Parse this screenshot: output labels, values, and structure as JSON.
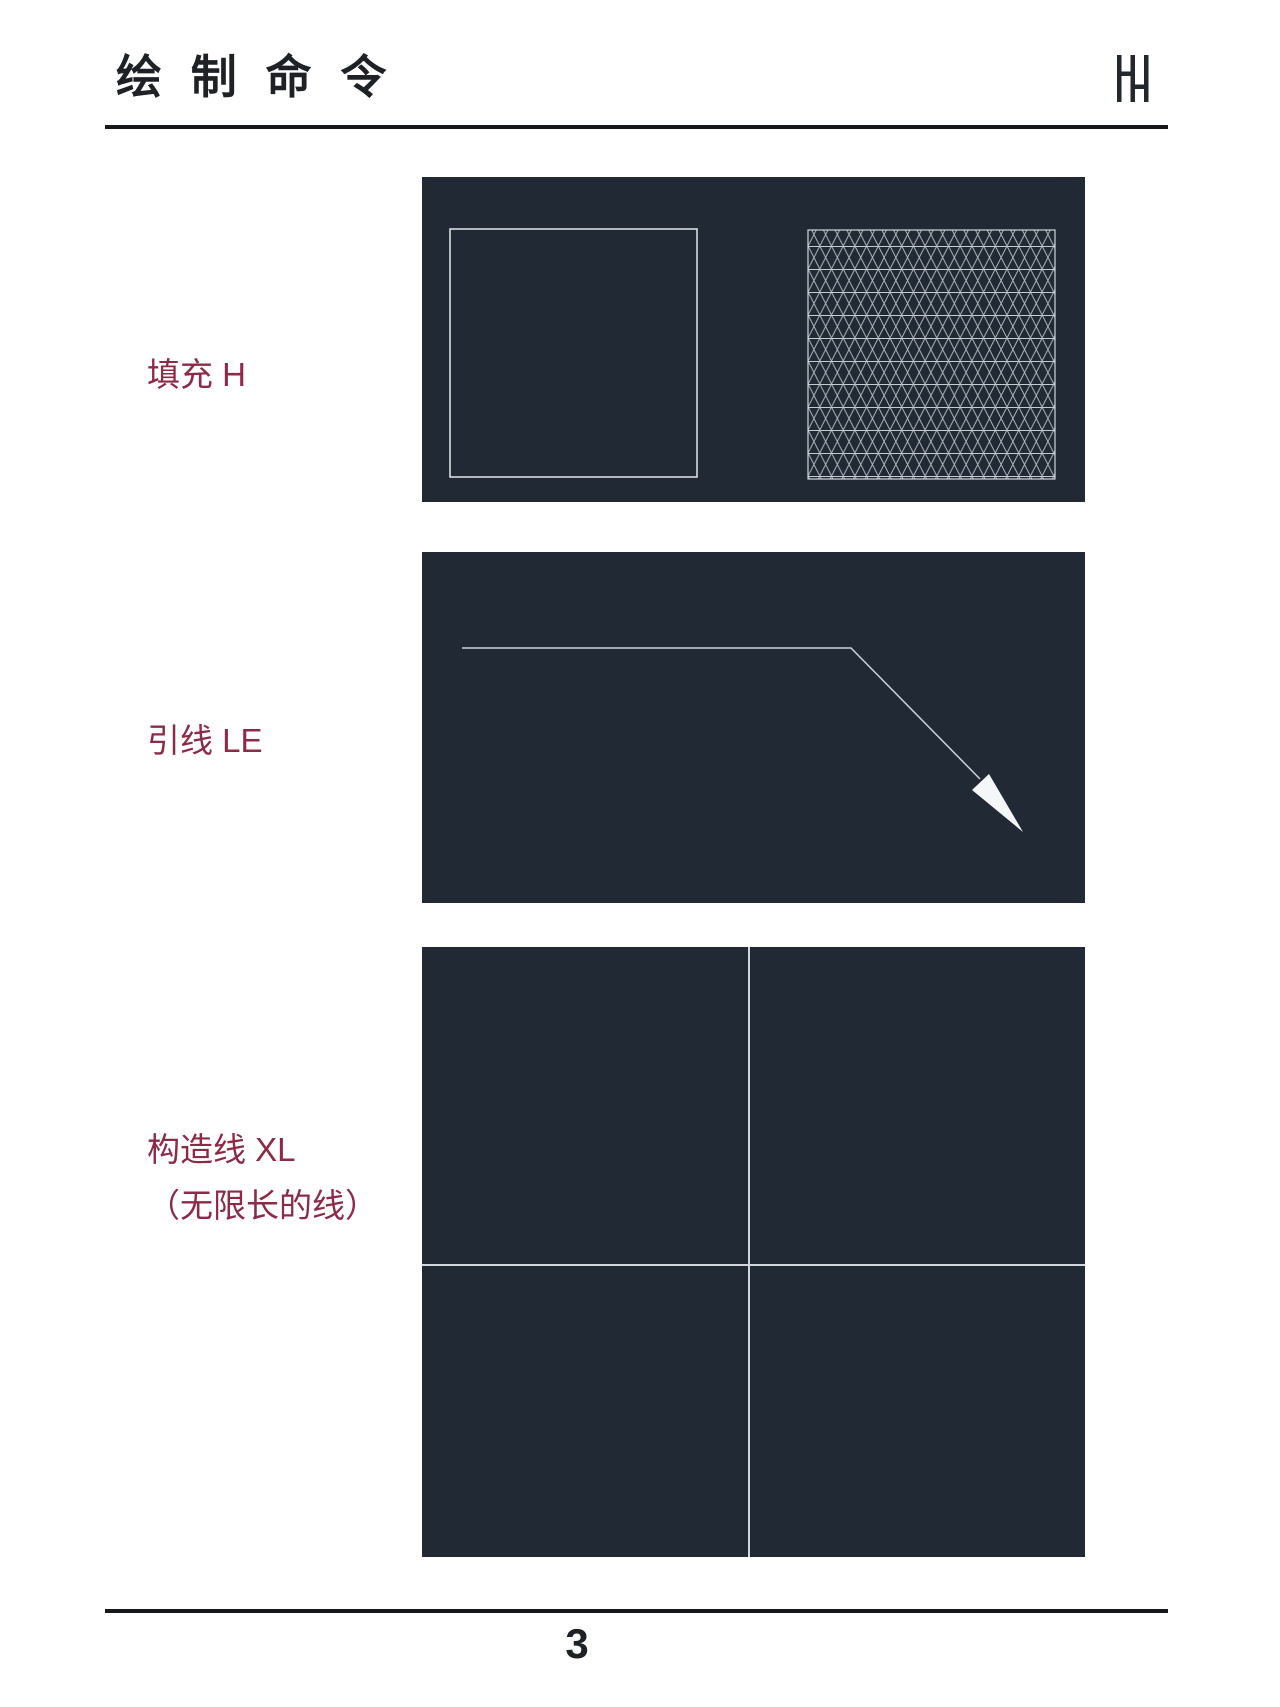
{
  "header": {
    "title": "绘 制 命 令",
    "logo": "double-h-monogram"
  },
  "sections": [
    {
      "id": "hatch",
      "label": "填充 H"
    },
    {
      "id": "leader",
      "label": "引线 LE"
    },
    {
      "id": "xline",
      "label": "构造线 XL",
      "label_note": "（无限长的线）"
    }
  ],
  "footer": {
    "page_number": "3"
  },
  "colors": {
    "page-bg": "#ffffff",
    "ink": "#1e2227",
    "rule": "#15181c",
    "label": "#8c2a48",
    "panel-bg": "#212a34",
    "cad-line": "#ccd2d9",
    "cad-bright": "#f4f6f8"
  }
}
